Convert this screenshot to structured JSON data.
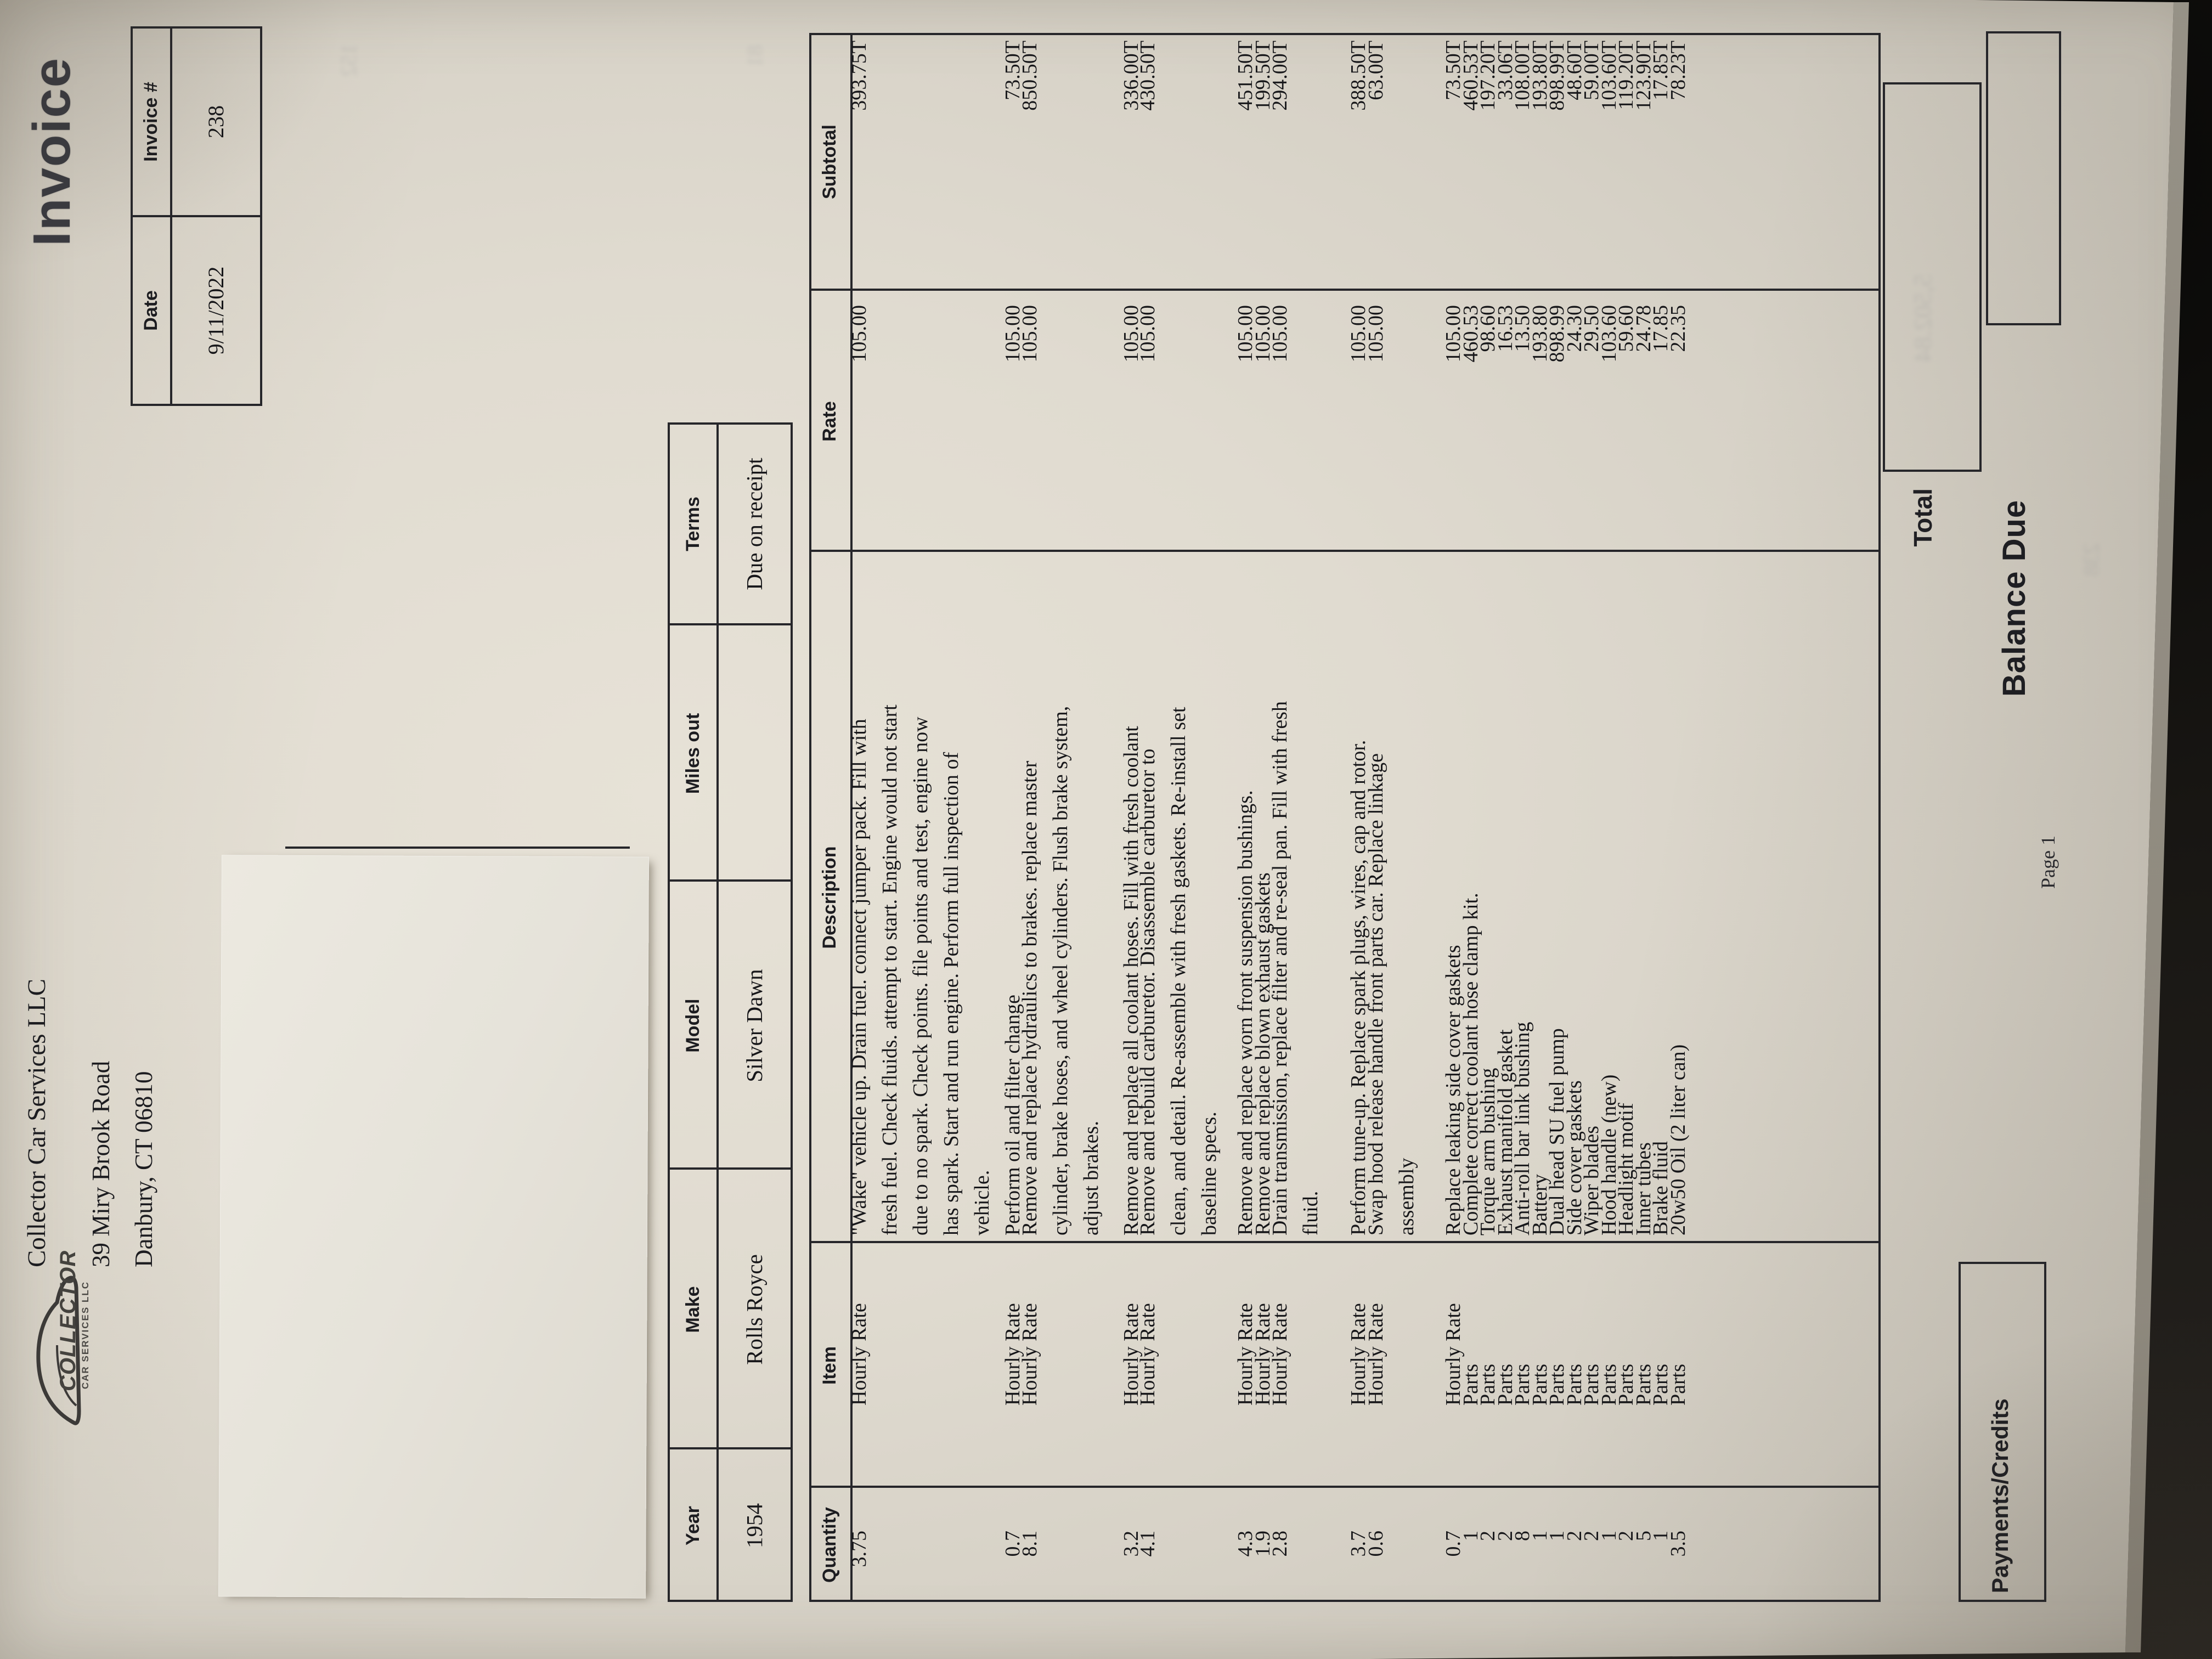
{
  "title": "Invoice",
  "company": {
    "name": "Collector Car Services LLC",
    "address1": "39 Miry Brook Road",
    "address2": "Danbury, CT 06810"
  },
  "logo": {
    "word1": "COLLECTOR",
    "word2": "CAR SERVICES LLC",
    "icon": "car-silhouette-icon"
  },
  "meta": {
    "date_label": "Date",
    "date_value": "9/11/2022",
    "invoice_label": "Invoice #",
    "invoice_value": "238"
  },
  "vehicle": {
    "headers": [
      "Year",
      "Make",
      "Model",
      "Miles out",
      "Terms"
    ],
    "values": [
      "1954",
      "Rolls Royce",
      "Silver Dawn",
      "",
      "Due on receipt"
    ]
  },
  "items": {
    "headers": [
      "Quantity",
      "Item",
      "Description",
      "Rate",
      "Subtotal"
    ],
    "rows": [
      {
        "qty": "3.75",
        "item": "Hourly Rate",
        "description": "\"Wake\" vehicle up. Drain fuel. connect jumper pack. Fill with\nfresh fuel. Check fluids. attempt to start. Engine would not start\ndue to no spark. Check points. file points and test, engine now\nhas spark. Start and run engine. Perform full inspection of\nvehicle.",
        "rate": "105.00",
        "subtotal": "393.75T"
      },
      {
        "qty": "0.7",
        "item": "Hourly Rate",
        "description": "Perform oil and filter change",
        "rate": "105.00",
        "subtotal": "73.50T"
      },
      {
        "qty": "8.1",
        "item": "Hourly Rate",
        "description": "Remove and replace hydraulics to brakes. replace master\ncylinder, brake hoses, and wheel cylinders. Flush brake system,\nadjust brakes.",
        "rate": "105.00",
        "subtotal": "850.50T"
      },
      {
        "qty": "3.2",
        "item": "Hourly Rate",
        "description": "Remove and replace all coolant hoses. Fill with fresh coolant",
        "rate": "105.00",
        "subtotal": "336.00T"
      },
      {
        "qty": "4.1",
        "item": "Hourly Rate",
        "description": "Remove and rebuild carburetor. Disassemble carburetor to\nclean, and detail. Re-assemble with fresh gaskets. Re-install set\nbaseline specs.",
        "rate": "105.00",
        "subtotal": "430.50T"
      },
      {
        "qty": "4.3",
        "item": "Hourly Rate",
        "description": "Remove and replace worn front suspension bushings.",
        "rate": "105.00",
        "subtotal": "451.50T"
      },
      {
        "qty": "1.9",
        "item": "Hourly Rate",
        "description": "Remove and replace blown exhaust gaskets",
        "rate": "105.00",
        "subtotal": "199.50T"
      },
      {
        "qty": "2.8",
        "item": "Hourly Rate",
        "description": "Drain transmission, replace filter and re-seal pan. Fill with fresh\nfluid.",
        "rate": "105.00",
        "subtotal": "294.00T"
      },
      {
        "qty": "3.7",
        "item": "Hourly Rate",
        "description": "Perform tune-up. Replace spark plugs, wires, cap and rotor.",
        "rate": "105.00",
        "subtotal": "388.50T"
      },
      {
        "qty": "0.6",
        "item": "Hourly Rate",
        "description": "Swap hood release handle front parts car. Replace linkage\nassembly",
        "rate": "105.00",
        "subtotal": "63.00T"
      },
      {
        "qty": "0.7",
        "item": "Hourly Rate",
        "description": "Replace leaking side cover gaskets",
        "rate": "105.00",
        "subtotal": "73.50T"
      },
      {
        "qty": "1",
        "item": "Parts",
        "description": "Complete correct coolant hose clamp kit.",
        "rate": "460.53",
        "subtotal": "460.53T"
      },
      {
        "qty": "2",
        "item": "Parts",
        "description": "Torque arm bushing",
        "rate": "98.60",
        "subtotal": "197.20T"
      },
      {
        "qty": "2",
        "item": "Parts",
        "description": "Exhaust manifold gasket",
        "rate": "16.53",
        "subtotal": "33.06T"
      },
      {
        "qty": "8",
        "item": "Parts",
        "description": "Anti-roll bar link bushing",
        "rate": "13.50",
        "subtotal": "108.00T"
      },
      {
        "qty": "1",
        "item": "Parts",
        "description": "Battery",
        "rate": "193.80",
        "subtotal": "193.80T"
      },
      {
        "qty": "1",
        "item": "Parts",
        "description": "Dual head SU fuel pump",
        "rate": "898.99",
        "subtotal": "898.99T"
      },
      {
        "qty": "2",
        "item": "Parts",
        "description": "Side cover gaskets",
        "rate": "24.30",
        "subtotal": "48.60T"
      },
      {
        "qty": "2",
        "item": "Parts",
        "description": "Wiper blades",
        "rate": "29.50",
        "subtotal": "59.00T"
      },
      {
        "qty": "1",
        "item": "Parts",
        "description": "Hood handle (new)",
        "rate": "103.60",
        "subtotal": "103.60T"
      },
      {
        "qty": "2",
        "item": "Parts",
        "description": "Headlight motif",
        "rate": "59.60",
        "subtotal": "119.20T"
      },
      {
        "qty": "5",
        "item": "Parts",
        "description": "Inner tubes",
        "rate": "24.78",
        "subtotal": "123.90T"
      },
      {
        "qty": "1",
        "item": "Parts",
        "description": "Brake fluid",
        "rate": "17.85",
        "subtotal": "17.85T"
      },
      {
        "qty": "3.5",
        "item": "Parts",
        "description": "20w50 Oil (2 liter can)",
        "rate": "22.35",
        "subtotal": "78.23T"
      }
    ]
  },
  "footer": {
    "payments_label": "Payments/Credits",
    "total_label": "Total",
    "balance_label": "Balance Due",
    "page_label": "Page 1"
  }
}
